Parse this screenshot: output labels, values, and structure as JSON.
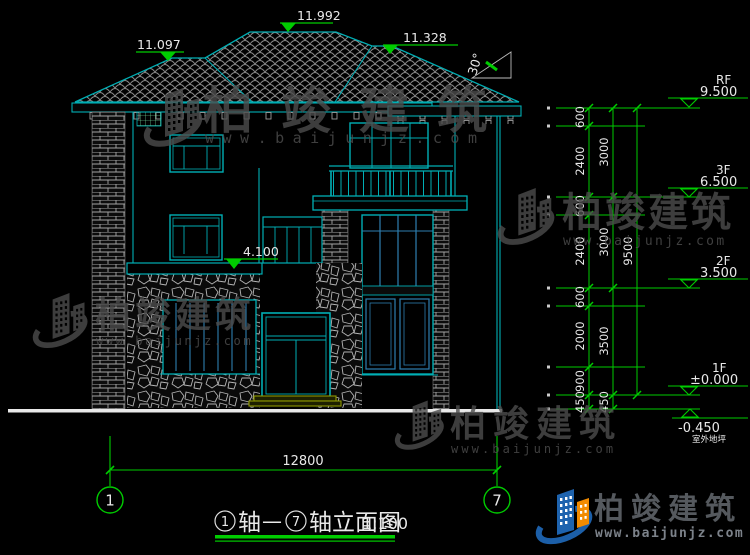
{
  "title": {
    "bubble_left": "1",
    "seg1": "轴",
    "dash": "—",
    "bubble_right": "7",
    "seg2": "轴立面图",
    "scale": "1:100"
  },
  "roof_marks": {
    "left": "11.097",
    "ridge": "11.992",
    "right": "11.328",
    "slope": "30°",
    "canopy": "4.100"
  },
  "levels": [
    {
      "label": "RF",
      "value": "9.500"
    },
    {
      "label": "3F",
      "value": "6.500"
    },
    {
      "label": "2F",
      "value": "3.500"
    },
    {
      "label": "1F",
      "value": "±0.000"
    },
    {
      "label": "室外地坪",
      "value": "-0.450"
    }
  ],
  "dims": {
    "segments": [
      "600",
      "2400",
      "600",
      "2400",
      "600",
      "2000",
      "900",
      "450"
    ],
    "floors": [
      "3000",
      "3000",
      "3500",
      "450"
    ],
    "total": "9500",
    "width": "12800"
  },
  "axes": {
    "left": "1",
    "right": "7"
  },
  "watermark": {
    "brand": "柏竣建筑",
    "site": "www.baijunjz.com"
  },
  "logo": {
    "brand": "柏竣建筑",
    "site": "www.baijunjz.com"
  },
  "colors": {
    "line": "#00AEB4",
    "dim": "#00CC00",
    "mullion": "#2E7EB0",
    "step": "#8F9900"
  }
}
